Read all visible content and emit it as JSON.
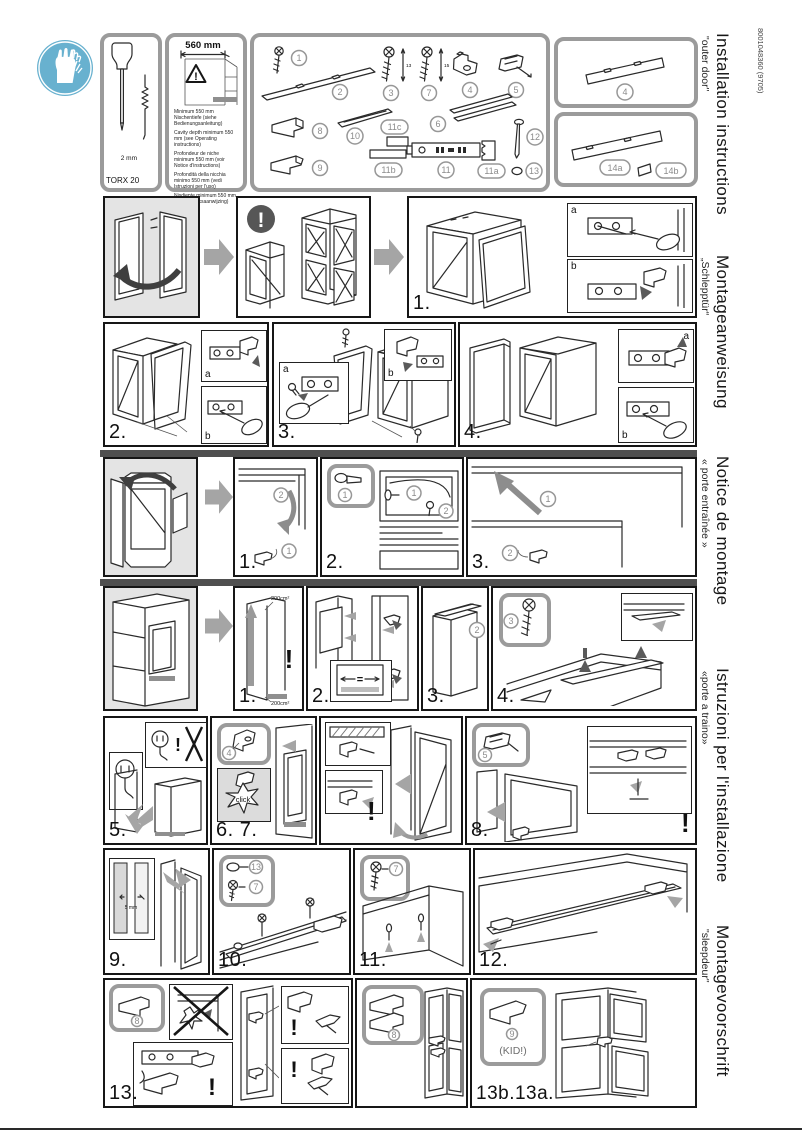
{
  "doc_number": "8001048360 (9705)",
  "sidebar": {
    "titles": [
      {
        "title": "Installation instructions",
        "subtitle": "\"outer door\""
      },
      {
        "title": "Montageanweisung",
        "subtitle": "„Schlepptür“"
      },
      {
        "title": "Notice de montage",
        "subtitle": "« porte entraînée »"
      },
      {
        "title": "Istruzioni per l'installazione",
        "subtitle": "«porte a traino»"
      },
      {
        "title": "Montagevoorschrift",
        "subtitle": "\"sleepdeur\""
      }
    ]
  },
  "toolbox": {
    "driver_label": "TORX 20",
    "hex_label": "2 mm"
  },
  "niche": {
    "width_label": "560 mm",
    "warning": "!",
    "notes": [
      "Minimum 550 mm Nischentiefe (siehe Bedienungsanleitung)",
      "Cavity depth minimum 550 mm (see Operating instructions)",
      "Profondeur de niche minimum 550 mm (voir Notice d'instructions)",
      "Profondità della nicchia minimo 550 mm (vedi Istruzioni per l'uso)",
      "Nisdiepte minimum 550 mm (zie Gebruiksaanwijzing)"
    ]
  },
  "parts": {
    "n1": "1",
    "n2": "2",
    "n3": "3",
    "n4": "4",
    "n5": "5",
    "n6": "6",
    "n7": "7",
    "n8": "8",
    "n9": "9",
    "n10": "10",
    "n11": "11",
    "n11a": "11a",
    "n11b": "11b",
    "n11c": "11c",
    "n12": "12",
    "n13": "13",
    "n14a": "14a",
    "n14b": "14b",
    "screw3_len": "13",
    "screw7_len": "15"
  },
  "seq": {
    "n1": "1",
    "n2": "2",
    "n3": "3"
  },
  "steps": {
    "s1": "1.",
    "s2": "2.",
    "s3": "3.",
    "s4": "4.",
    "r4s1": "1.",
    "r4s2": "2.",
    "r4s3": "3.",
    "r5s1": "1.",
    "r5s2": "2.",
    "r5s3": "3.",
    "r5s4": "4.",
    "s5": "5.",
    "s67": "6. 7.",
    "s8": "8.",
    "s9": "9.",
    "s10": "10.",
    "s11": "11.",
    "s12": "12.",
    "s13": "13.",
    "s13b": "13b.13a."
  },
  "labels": {
    "a": "a",
    "b": "b",
    "click": "click",
    "kid": "(KID!)",
    "gap": "5 mm",
    "vent_top": "200cm²",
    "vent_bottom": "200cm²",
    "equal": "=",
    "excl": "!"
  }
}
